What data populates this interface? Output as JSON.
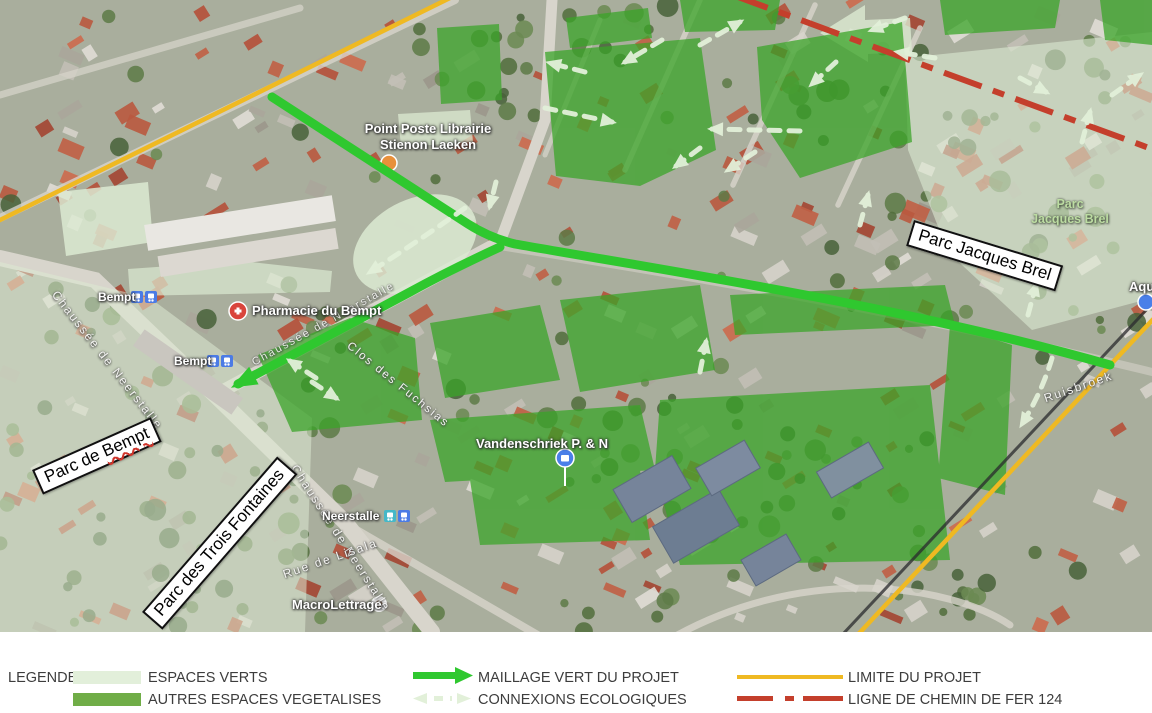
{
  "colors": {
    "maillage": "#2fc82f",
    "connexions": "#e2f0d9",
    "limite": "#efb922",
    "railway": "#c43f2c",
    "espaces_verts": "#e2efda",
    "autres_espaces": "#70ad47",
    "overlay_dark": "#3aa528",
    "overlay_light": "#dcead2"
  },
  "map": {
    "box_labels": {
      "jacques_brel": "Parc Jacques Brel",
      "bempt_prefix": "Parc de ",
      "bempt_word": "Bempt",
      "trois_fontaines": "Parc des Trois Fontaines"
    },
    "park_label": {
      "line1": "Parc",
      "line2": "Jacques Brel"
    },
    "poi": {
      "point_poste_line1": "Point Poste Librairie",
      "point_poste_line2": "Stienon Laeken",
      "pharmacie": "Pharmacie du Bempt",
      "bempt_stop_1": "Bempt",
      "bempt_stop_2": "Bempt",
      "neerstalle_stop": "Neerstalle",
      "macrolettrage": "MacroLettrage",
      "vandenschriek": "Vandenschriek P. & N",
      "aqua": "Aqu"
    },
    "streets": {
      "chaussee_neerstalle_1": "Chaussée de Neerstalle",
      "chaussee_neerstalle_2": "Chaussée de Neerstalle",
      "chaussee_neerstalle_3": "Chaussée de Neerstalle",
      "clos_fuchsias": "Clos des Fuchsias",
      "rue_lisala": "Rue de Lisala",
      "ruisbroek": "Ruisbroek"
    }
  },
  "legend": {
    "title": "LEGENDE :",
    "items": [
      {
        "label": "ESPACES VERTS"
      },
      {
        "label": "AUTRES ESPACES VEGETALISES"
      },
      {
        "label": "MAILLAGE VERT DU PROJET"
      },
      {
        "label": "CONNEXIONS ECOLOGIQUES"
      },
      {
        "label": "LIMITE DU PROJET"
      },
      {
        "label": "LIGNE DE CHEMIN DE FER 124"
      }
    ]
  }
}
